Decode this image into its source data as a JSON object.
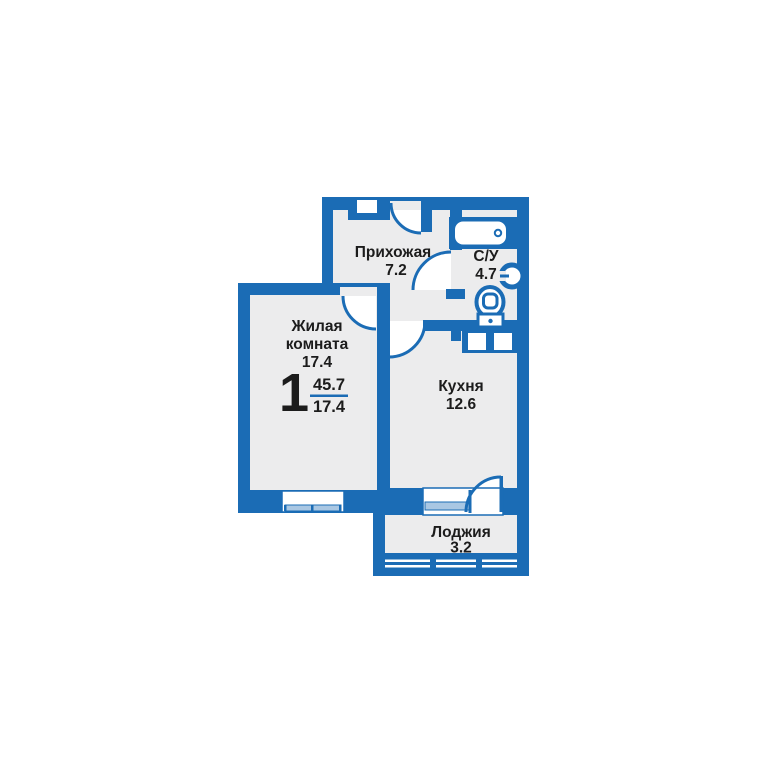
{
  "plan": {
    "apartment": {
      "rooms_label": "1",
      "total_area": "45.7",
      "living_area": "17.4"
    },
    "rooms": [
      {
        "id": "hallway",
        "name": "Прихожая",
        "area": "7.2"
      },
      {
        "id": "bathroom",
        "name": "С/У",
        "area": "4.7"
      },
      {
        "id": "living",
        "name_line1": "Жилая",
        "name_line2": "комната",
        "area": "17.4"
      },
      {
        "id": "kitchen",
        "name": "Кухня",
        "area": "12.6"
      },
      {
        "id": "loggia",
        "name": "Лоджия",
        "area": "3.2"
      }
    ],
    "colors": {
      "wall": "#1B6CB5",
      "floor": "#ECECED",
      "glass": "#A9C7E3",
      "text": "#1C1C1C"
    }
  }
}
